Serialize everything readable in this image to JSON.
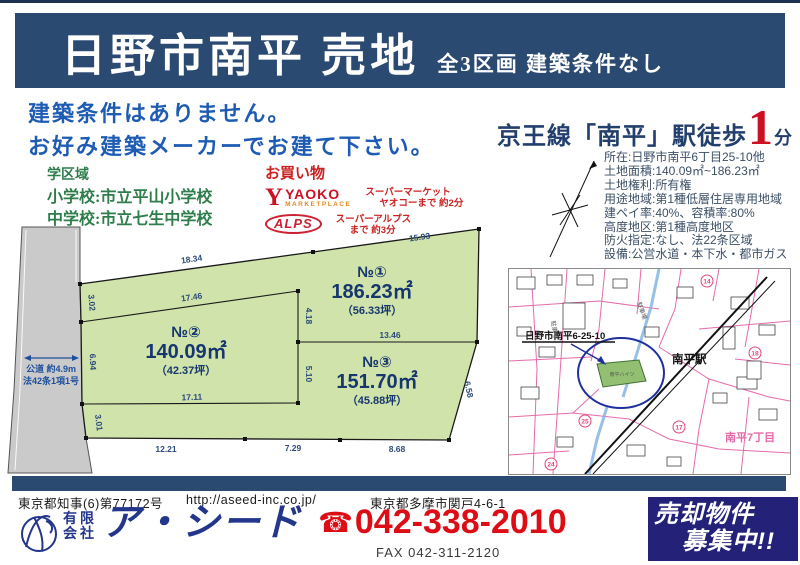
{
  "colors": {
    "header_navy": "#2a4a72",
    "catch_blue": "#1e5cb3",
    "accent_red": "#cc1122",
    "school_green": "#2e7d4a",
    "phone_red": "#dc0d15",
    "banner_navy": "#232178",
    "land_green": "#d0e3ab",
    "road_gray": "#cacaca",
    "map_pink": "#e668a8",
    "logo_navy": "#23368c"
  },
  "header": {
    "title": "日野市南平 売地",
    "subtitle": "全3区画 建築条件なし"
  },
  "catch": {
    "line1": "建築条件はありません。",
    "line2": "お好み建築メーカーでお建て下さい。"
  },
  "station": {
    "prefix": "京王線「南平」駅徒歩",
    "minutes": "1",
    "suffix": "分"
  },
  "school": {
    "heading": "学区域",
    "elementary": "小学校:市立平山小学校",
    "junior_high": "中学校:市立七生中学校"
  },
  "shopping": {
    "heading": "お買い物",
    "yaoko": {
      "logo_y": "Y",
      "logo_main": "YAOKO",
      "logo_sub": "MARKETPLACE",
      "desc_line1": "スーパーマーケット",
      "desc_line2": "ヤオコーまで 約2分"
    },
    "alps": {
      "logo": "ALPS",
      "desc_line1": "スーパーアルプス",
      "desc_line2": "まで 約3分"
    }
  },
  "property": {
    "lines": [
      "所在:日野市南平6丁目25-10他",
      "土地面積:140.09㎡~186.23㎡",
      "土地権利:所有権",
      "用途地域:第1種低層住居専用地域",
      "建ペイ率:40%、容積率:80%",
      "高度地区:第1種高度地区",
      "防火指定:なし、法22条区域",
      "設備:公営水道・本下水・都市ガス"
    ]
  },
  "plot": {
    "road_label1": "公道 約4.9m",
    "road_label2": "法42条1項1号",
    "parcels": [
      {
        "no": "№①",
        "sqm": "186.23㎡",
        "tsubo": "（56.33坪）"
      },
      {
        "no": "№②",
        "sqm": "140.09㎡",
        "tsubo": "（42.37坪）"
      },
      {
        "no": "№③",
        "sqm": "151.70㎡",
        "tsubo": "（45.88坪）"
      }
    ],
    "dims": {
      "top_left": "18.34",
      "top_right": "15.93",
      "left_top": "3.02",
      "left_mid": "6.94",
      "left_bottom": "3.01",
      "no2_top": "17.46",
      "no2_right_upper": "4.18",
      "no2_right_lower": "5.10",
      "no2_bottom": "17.11",
      "divider": "13.46",
      "bottom_left": "12.21",
      "bottom_mid": "7.29",
      "bottom_right": "8.68",
      "right_slant": "6.58"
    }
  },
  "map": {
    "callout": "日野市南平6-25-10",
    "station_label": "南平駅",
    "district_label": "南平7丁目",
    "parking_label": "駐車場",
    "building_label": "南平ハイツ",
    "badges": [
      "14",
      "18",
      "25",
      "17",
      "24"
    ]
  },
  "footer": {
    "license": "東京都知事(6)第77172号",
    "url": "http://aseed-inc.co.jp/",
    "address": "東京都多摩市関戸4-6-1",
    "company_type_top": "有限",
    "company_type_bottom": "会社",
    "company_name": "ア・シード",
    "tel_icon": "☎",
    "tel": "042-338-2010",
    "fax": "FAX 042-311-2120",
    "banner_line1": "売却物件",
    "banner_line2": "募集中!!"
  }
}
